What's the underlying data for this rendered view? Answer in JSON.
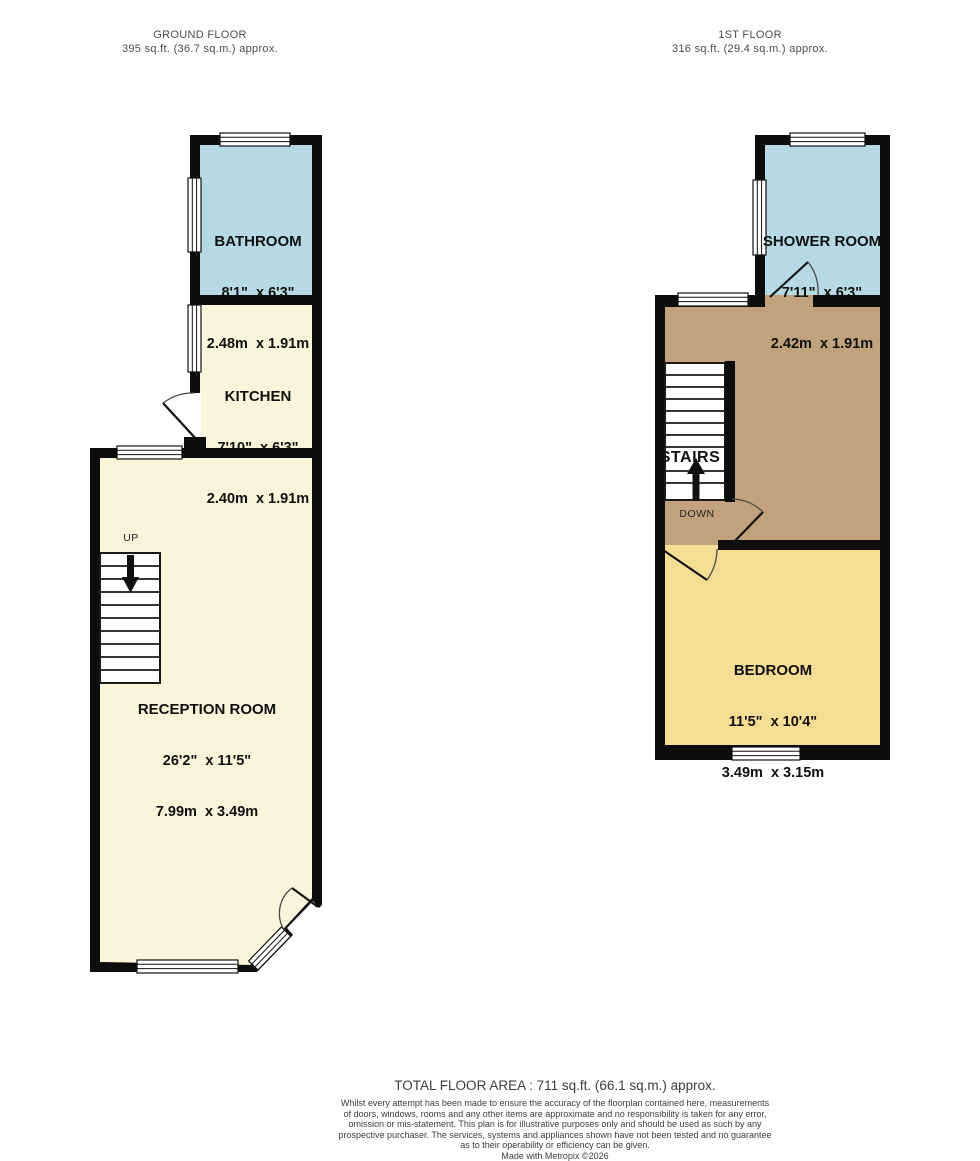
{
  "headers": {
    "ground": {
      "title": "GROUND FLOOR",
      "area": "395 sq.ft. (36.7 sq.m.) approx."
    },
    "first": {
      "title": "1ST FLOOR",
      "area": "316 sq.ft. (29.4 sq.m.) approx."
    }
  },
  "rooms": {
    "bathroom": {
      "name": "BATHROOM",
      "imperial": "8'1\"  x 6'3\"",
      "metric": "2.48m  x 1.91m"
    },
    "kitchen": {
      "name": "KITCHEN",
      "imperial": "7'10\"  x 6'3\"",
      "metric": "2.40m  x 1.91m"
    },
    "reception": {
      "name": "RECEPTION ROOM",
      "imperial": "26'2\"  x 11'5\"",
      "metric": "7.99m  x 3.49m"
    },
    "shower": {
      "name": "SHOWER ROOM",
      "imperial": "7'11\"  x 6'3\"",
      "metric": "2.42m  x 1.91m"
    },
    "bedroom": {
      "name": "BEDROOM",
      "imperial": "11'5\"  x 10'4\"",
      "metric": "3.49m  x 3.15m"
    }
  },
  "stairs": {
    "up": "UP",
    "down": "DOWN",
    "label": "STAIRS"
  },
  "footer": {
    "total": "TOTAL FLOOR AREA : 711 sq.ft. (66.1 sq.m.) approx.",
    "disclaimer": [
      "Whilst every attempt has been made to ensure the accuracy of the floorplan contained here, measurements",
      "of doors, windows, rooms and any other items are approximate and no responsibility is taken for any error,",
      "omission or mis-statement. This plan is for illustrative purposes only and should be used as such by any",
      "prospective purchaser. The services, systems and appliances shown have not been tested and no guarantee",
      "as to their operability or efficiency can be given."
    ],
    "credit": "Made with Metropix ©2026"
  },
  "colors": {
    "wall": "#0d0d0d",
    "wet_room": "#b5dae3",
    "living": "#faf4da",
    "bedroom_fill": "#f6dd94",
    "landing": "#c1a27c",
    "window_fill": "#ffffff"
  }
}
